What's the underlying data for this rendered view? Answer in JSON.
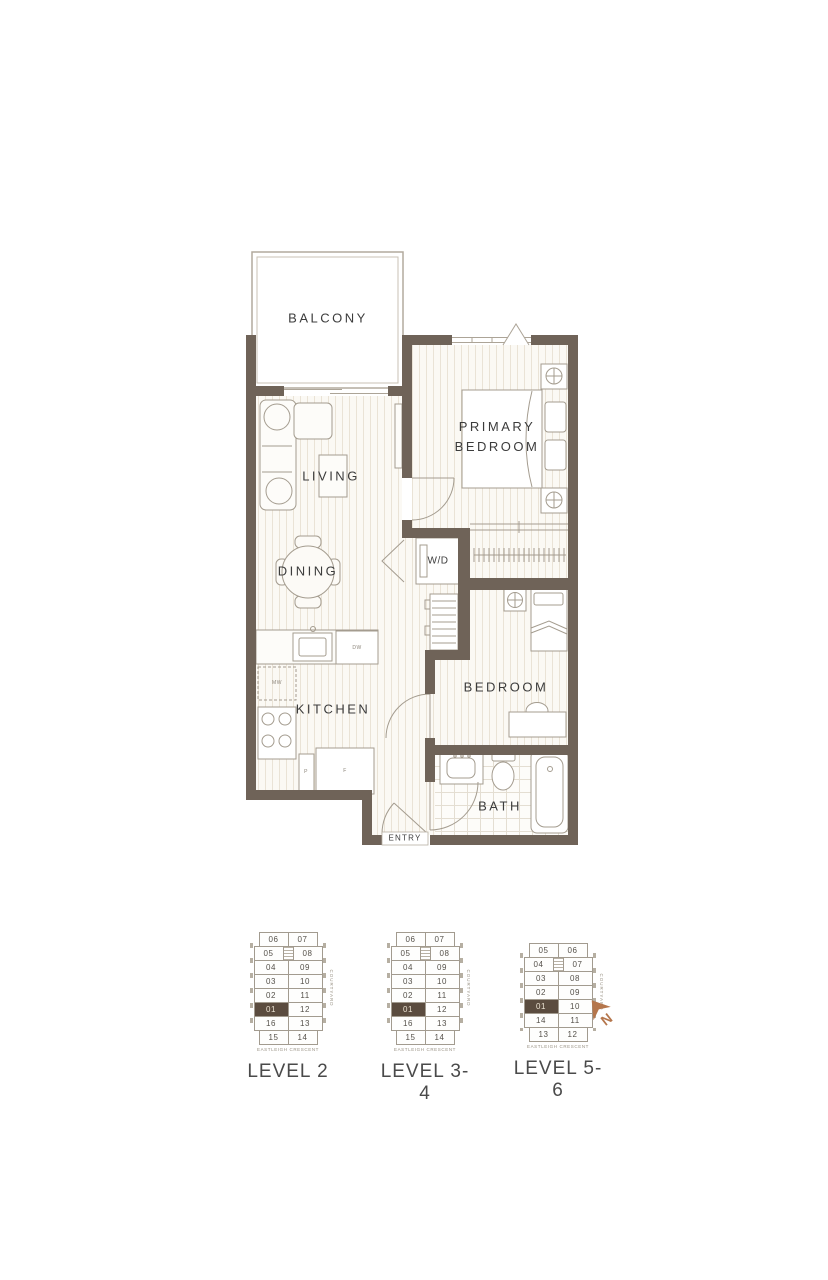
{
  "floorplan": {
    "rooms": {
      "balcony": "BALCONY",
      "living": "LIVING",
      "dining": "DINING",
      "kitchen": "KITCHEN",
      "laundry": "W/D",
      "primary_bedroom": "PRIMARY BEDROOM",
      "bedroom": "BEDROOM",
      "bath": "BATH",
      "entry": "ENTRY"
    },
    "appliances": {
      "dishwasher": "DW",
      "microwave": "MW",
      "pantry": "P",
      "fridge": "F"
    },
    "colors": {
      "wall": "#6F6358",
      "linework": "#A49C8F",
      "floor_stripe": "#EAE3D6",
      "label": "#3C3C3C",
      "highlight": "#5B4C3F",
      "north_arrow": "#B5764C"
    }
  },
  "keyplans": [
    {
      "label": "LEVEL 2",
      "highlight_unit": "01",
      "courtyard_label": "COURTYARD",
      "street_label": "EASTLEIGH CRESCENT",
      "rows": [
        [
          "06",
          "07"
        ],
        [
          "05",
          "08"
        ],
        [
          "04",
          "09"
        ],
        [
          "03",
          "10"
        ],
        [
          "02",
          "11"
        ],
        [
          "01",
          "12"
        ],
        [
          "16",
          "13"
        ],
        [
          "15",
          "14"
        ]
      ]
    },
    {
      "label": "LEVEL 3-4",
      "highlight_unit": "01",
      "courtyard_label": "COURTYARD",
      "street_label": "EASTLEIGH CRESCENT",
      "rows": [
        [
          "06",
          "07"
        ],
        [
          "05",
          "08"
        ],
        [
          "04",
          "09"
        ],
        [
          "03",
          "10"
        ],
        [
          "02",
          "11"
        ],
        [
          "01",
          "12"
        ],
        [
          "16",
          "13"
        ],
        [
          "15",
          "14"
        ]
      ]
    },
    {
      "label": "LEVEL 5-6",
      "highlight_unit": "01",
      "courtyard_label": "COURTYARD",
      "street_label": "EASTLEIGH CRESCENT",
      "rows": [
        [
          "05",
          "06"
        ],
        [
          "04",
          "07"
        ],
        [
          "03",
          "08"
        ],
        [
          "02",
          "09"
        ],
        [
          "01",
          "10"
        ],
        [
          "14",
          "11"
        ],
        [
          "13",
          "12"
        ]
      ]
    }
  ],
  "compass": {
    "label": "N"
  }
}
